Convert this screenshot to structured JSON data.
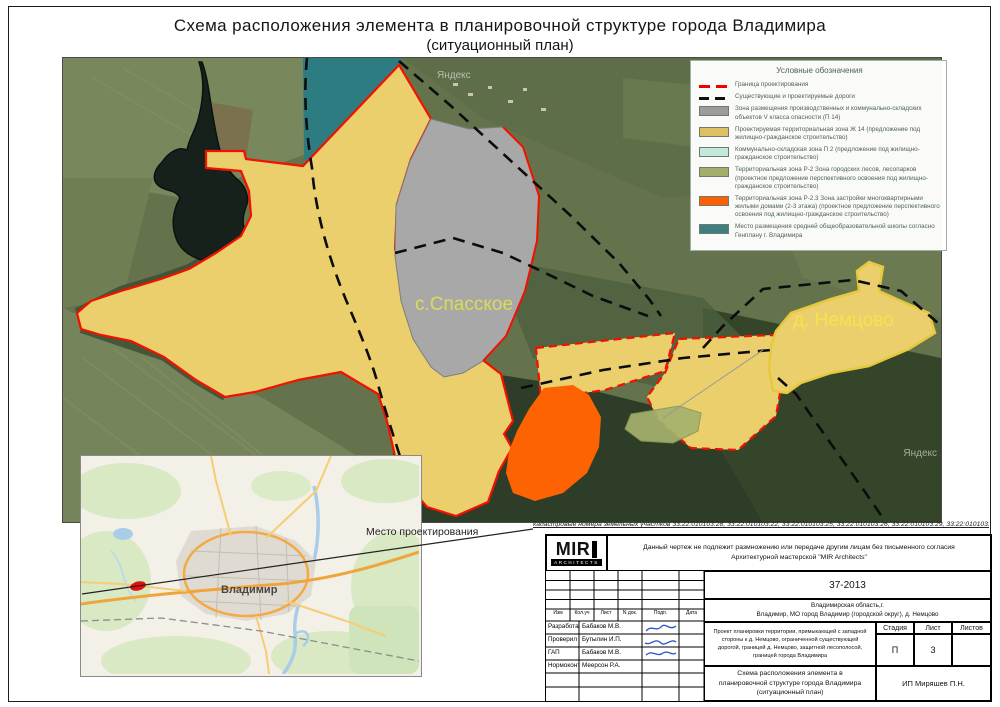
{
  "page": {
    "title_line1": "Схема расположения элемента в планировочной структуре города Владимира",
    "title_line2": "(ситуационный план)"
  },
  "map": {
    "labels": {
      "spasskoe": "с.Спасское",
      "nemtsovo": "д. Немцово"
    },
    "watermark": "Яндекс"
  },
  "legend": {
    "title": "Условные обозначения",
    "items": [
      {
        "type": "line-dashed",
        "color": "#F20000",
        "label": "Граница проектирования"
      },
      {
        "type": "line-dashed",
        "color": "#111111",
        "label": "Существующие и проектируемые дороги"
      },
      {
        "type": "box",
        "color": "#9C9C9C",
        "label": "Зона размещения производственных и коммунально-складских объектов V класса опасности (П 14)"
      },
      {
        "type": "box",
        "color": "#DDC062",
        "label": "Проектируемая территориальная зона Ж 14 (предложение под жилищно-гражданское строительство)"
      },
      {
        "type": "box",
        "color": "#C2E8D9",
        "label": "Коммунально-складская зона П 2 (предложение под жилищно-гражданское строительство)"
      },
      {
        "type": "box",
        "color": "#A2AE69",
        "label": "Территориальная зона Р-2 Зона городских лесов, лесопарков (проектное предложение перспективного освоения под жилищно-гражданское строительство)"
      },
      {
        "type": "box",
        "color": "#FD5F02",
        "label": "Территориальная зона Р-2.3 Зона застройки многоквартирными жилыми домами (2-3 этажа) (проектное предложение перспективного освоения под жилищно-гражданское строительство)"
      },
      {
        "type": "box",
        "color": "#3E7F81",
        "label": "Место размещения средней общеобразовательной школы согласно Генплану г. Владимира"
      }
    ]
  },
  "inset": {
    "city_label": "Владимир",
    "callout": "Место проектирования"
  },
  "cadastral_note": "кадастровые номера земельных участков 33:22:010103:28, 33:22:010103:22, 33:22:010103:25, 33:22:010103:26, 33:22:010103:29, 33:22:010103:23, 33:22:010103:127",
  "stamp": {
    "logo_text": "MIR",
    "logo_sub": "ARCHITECTS",
    "disclaimer_line1": "Данный чертеж не подлежит размножению или передаче другим лицам без письменного согласия",
    "disclaimer_line2": "Архитектурной мастерской \"MIR Architects\"",
    "doc_number": "37-2013",
    "location_line1": "Владимирская область,г.",
    "location_line2": "Владимир, МО город Владимир (городской округ), д. Немцово",
    "grid_headers": [
      "Изм",
      "Кол.уч",
      "Лист",
      "N док.",
      "Подп.",
      "Дата"
    ],
    "roles": [
      {
        "role": "Разработал",
        "name": "Бабаков М.В."
      },
      {
        "role": "Проверил",
        "name": "Бутылин И.П."
      },
      {
        "role": "ГАП",
        "name": "Бабаков М.В."
      },
      {
        "role": "Нормоконтр",
        "name": "Меерсон Р.А."
      }
    ],
    "project_description": "Проект планировки территории, примыкающей с западной стороны к д. Немцово, ограниченной существующей дорогой, границей д. Немцово, защитной лесополосой, границей города Владимира",
    "stage_headers": [
      "Стадия",
      "Лист",
      "Листов"
    ],
    "stage": "П",
    "sheet": "3",
    "sheets_total": "",
    "drawing_title": "Схема расположения элемента в планировочной структуре города Владимира (ситуационный план)",
    "company": "ИП Миряшев П.Н."
  },
  "colors": {
    "boundary_red": "#F21000",
    "road_black": "#0C0C0C",
    "zone_industrial_gray": "#A8A8A8",
    "zone_zh14_yellow": "#ECCF6D",
    "zone_p2_cyan": "#C2E8D9",
    "zone_r2_olive": "#A5B26D",
    "zone_r23_orange": "#FD6302",
    "school_teal": "#2D7C81"
  }
}
